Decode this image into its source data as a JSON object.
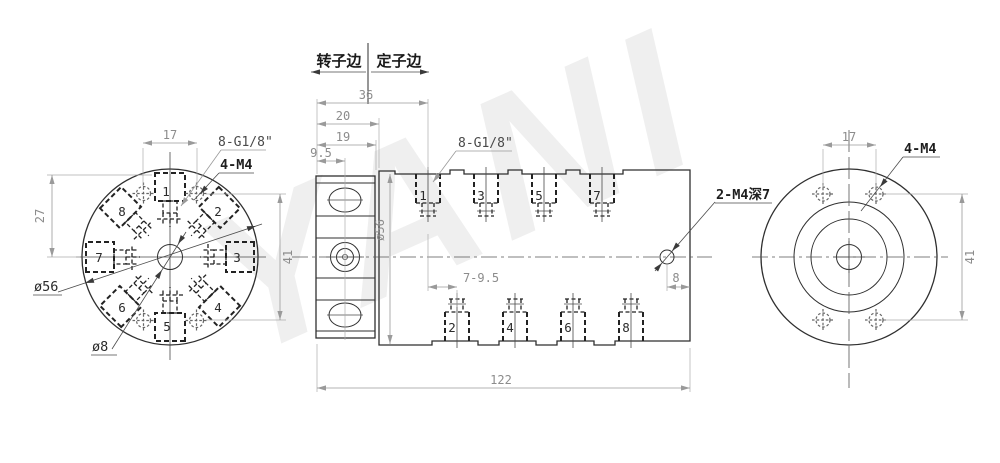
{
  "drawing": {
    "watermark": "YANI",
    "header": {
      "rotor_side": "转子边",
      "stator_side": "定子边"
    },
    "left_view": {
      "dim_17": "17",
      "dim_27": "27",
      "dim_41": "41",
      "label_ports": "8-G1/8\"",
      "label_m4": "4-M4",
      "label_dia56": "ø56",
      "label_dia8": "ø8",
      "ports": [
        "1",
        "2",
        "3",
        "4",
        "5",
        "6",
        "7",
        "8"
      ]
    },
    "middle_view": {
      "dim_36": "36",
      "dim_20": "20",
      "dim_19": "19",
      "dim_9_5": "9.5",
      "dim_dia56": "ø56",
      "dim_7_9_5": "7-9.5",
      "dim_8": "8",
      "dim_122": "122",
      "label_ports": "8-G1/8\"",
      "label_side_holes": "2-M4深7",
      "top_ports": [
        "1",
        "3",
        "5",
        "7"
      ],
      "bottom_ports": [
        "2",
        "4",
        "6",
        "8"
      ]
    },
    "right_view": {
      "dim_17": "17",
      "dim_41": "41",
      "label_m4": "4-M4"
    }
  }
}
